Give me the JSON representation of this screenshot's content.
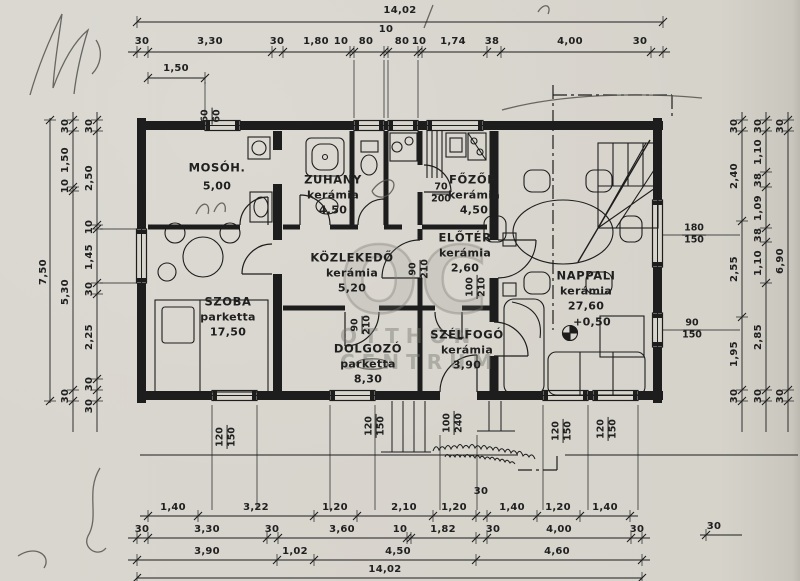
{
  "document": {
    "kind": "scanned floor plan",
    "language": "hu"
  },
  "watermark": {
    "monogram": "OC",
    "line1": "OTTHON",
    "line2": "CENTRUM"
  },
  "level_mark": {
    "text": "+0,50",
    "x": 592,
    "y": 322
  },
  "rooms": [
    {
      "name": "MOSÓH.",
      "finish": null,
      "area": "5,00",
      "x": 217,
      "y": 168
    },
    {
      "name": "ZUHANY",
      "finish": "kerámia",
      "area": "4,50",
      "x": 333,
      "y": 180
    },
    {
      "name": "FŐZŐF.",
      "finish": "kerámia",
      "area": "4,50",
      "x": 474,
      "y": 180
    },
    {
      "name": "ELŐTÉR",
      "finish": "kerámia",
      "area": "2,60",
      "x": 465,
      "y": 238
    },
    {
      "name": "KÖZLEKEDŐ",
      "finish": "kerámia",
      "area": "5,20",
      "x": 352,
      "y": 258
    },
    {
      "name": "SZOBA",
      "finish": "parketta",
      "area": "17,50",
      "x": 228,
      "y": 302
    },
    {
      "name": "DOLGOZÓ",
      "finish": "parketta",
      "area": "8,30",
      "x": 368,
      "y": 349
    },
    {
      "name": "SZÉLFOGÓ",
      "finish": "kerámia",
      "area": "3,90",
      "x": 467,
      "y": 335
    },
    {
      "name": "NAPPALI",
      "finish": "kerámia",
      "area": "27,60",
      "x": 586,
      "y": 276
    }
  ],
  "dim_labels": [
    {
      "t": "14,02",
      "x": 400,
      "y": 11
    },
    {
      "t": "30",
      "x": 142,
      "y": 42
    },
    {
      "t": "3,30",
      "x": 210,
      "y": 42
    },
    {
      "t": "30",
      "x": 277,
      "y": 42
    },
    {
      "t": "1,80",
      "x": 316,
      "y": 42
    },
    {
      "t": "10",
      "x": 341,
      "y": 42
    },
    {
      "t": "80",
      "x": 366,
      "y": 42
    },
    {
      "t": "10",
      "x": 386,
      "y": 30
    },
    {
      "t": "80",
      "x": 402,
      "y": 42
    },
    {
      "t": "10",
      "x": 419,
      "y": 42
    },
    {
      "t": "1,74",
      "x": 453,
      "y": 42
    },
    {
      "t": "38",
      "x": 492,
      "y": 42
    },
    {
      "t": "4,00",
      "x": 570,
      "y": 42
    },
    {
      "t": "30",
      "x": 640,
      "y": 42
    },
    {
      "t": "1,50",
      "x": 176,
      "y": 69
    },
    {
      "t": "1,40",
      "x": 173,
      "y": 508
    },
    {
      "t": "3,22",
      "x": 256,
      "y": 508
    },
    {
      "t": "1,20",
      "x": 335,
      "y": 508
    },
    {
      "t": "2,10",
      "x": 404,
      "y": 508
    },
    {
      "t": "1,20",
      "x": 454,
      "y": 508
    },
    {
      "t": "30",
      "x": 481,
      "y": 492
    },
    {
      "t": "1,40",
      "x": 512,
      "y": 508
    },
    {
      "t": "1,20",
      "x": 558,
      "y": 508
    },
    {
      "t": "1,40",
      "x": 605,
      "y": 508
    },
    {
      "t": "30",
      "x": 142,
      "y": 530
    },
    {
      "t": "3,30",
      "x": 207,
      "y": 530
    },
    {
      "t": "30",
      "x": 272,
      "y": 530
    },
    {
      "t": "3,60",
      "x": 342,
      "y": 530
    },
    {
      "t": "10",
      "x": 400,
      "y": 530
    },
    {
      "t": "1,82",
      "x": 443,
      "y": 530
    },
    {
      "t": "30",
      "x": 493,
      "y": 530
    },
    {
      "t": "4,00",
      "x": 559,
      "y": 530
    },
    {
      "t": "30",
      "x": 637,
      "y": 530
    },
    {
      "t": "3,90",
      "x": 207,
      "y": 552
    },
    {
      "t": "1,02",
      "x": 295,
      "y": 552
    },
    {
      "t": "4,50",
      "x": 398,
      "y": 552
    },
    {
      "t": "4,60",
      "x": 557,
      "y": 552
    },
    {
      "t": "14,02",
      "x": 385,
      "y": 570
    },
    {
      "t": "30",
      "x": 714,
      "y": 527
    },
    {
      "t": "7,50",
      "x": 44,
      "y": 272,
      "r": 1
    },
    {
      "t": "30",
      "x": 66,
      "y": 126,
      "r": 1
    },
    {
      "t": "1,50",
      "x": 66,
      "y": 160,
      "r": 1
    },
    {
      "t": "10",
      "x": 66,
      "y": 186,
      "r": 1
    },
    {
      "t": "5,30",
      "x": 66,
      "y": 292,
      "r": 1
    },
    {
      "t": "30",
      "x": 66,
      "y": 396,
      "r": 1
    },
    {
      "t": "30",
      "x": 90,
      "y": 126,
      "r": 1
    },
    {
      "t": "2,50",
      "x": 90,
      "y": 178,
      "r": 1
    },
    {
      "t": "10",
      "x": 90,
      "y": 227,
      "r": 1
    },
    {
      "t": "1,45",
      "x": 90,
      "y": 257,
      "r": 1
    },
    {
      "t": "30",
      "x": 90,
      "y": 289,
      "r": 1
    },
    {
      "t": "2,25",
      "x": 90,
      "y": 337,
      "r": 1
    },
    {
      "t": "30",
      "x": 90,
      "y": 384,
      "r": 1
    },
    {
      "t": "30",
      "x": 90,
      "y": 406,
      "r": 1
    },
    {
      "t": "30",
      "x": 735,
      "y": 126,
      "r": 1
    },
    {
      "t": "2,40",
      "x": 735,
      "y": 176,
      "r": 1
    },
    {
      "t": "2,55",
      "x": 735,
      "y": 269,
      "r": 1
    },
    {
      "t": "1,95",
      "x": 735,
      "y": 354,
      "r": 1
    },
    {
      "t": "30",
      "x": 735,
      "y": 396,
      "r": 1
    },
    {
      "t": "30",
      "x": 759,
      "y": 126,
      "r": 1
    },
    {
      "t": "1,10",
      "x": 759,
      "y": 152,
      "r": 1
    },
    {
      "t": "38",
      "x": 759,
      "y": 180,
      "r": 1
    },
    {
      "t": "1,09",
      "x": 759,
      "y": 208,
      "r": 1
    },
    {
      "t": "38",
      "x": 759,
      "y": 235,
      "r": 1
    },
    {
      "t": "1,10",
      "x": 759,
      "y": 263,
      "r": 1
    },
    {
      "t": "2,85",
      "x": 759,
      "y": 337,
      "r": 1
    },
    {
      "t": "30",
      "x": 759,
      "y": 396,
      "r": 1
    },
    {
      "t": "30",
      "x": 781,
      "y": 126,
      "r": 1
    },
    {
      "t": "6,90",
      "x": 781,
      "y": 261,
      "r": 1
    },
    {
      "t": "30",
      "x": 781,
      "y": 396,
      "r": 1
    }
  ],
  "fixture_pairs": [
    {
      "a": "60",
      "b": "60",
      "x": 212,
      "y": 116,
      "rot": 1
    },
    {
      "a": "70",
      "b": "200",
      "x": 441,
      "y": 194,
      "rot": 0
    },
    {
      "a": "90",
      "b": "210",
      "x": 420,
      "y": 269,
      "rot": 1
    },
    {
      "a": "90",
      "b": "210",
      "x": 362,
      "y": 325,
      "rot": 1
    },
    {
      "a": "100",
      "b": "210",
      "x": 477,
      "y": 287,
      "rot": 1
    },
    {
      "a": "100",
      "b": "240",
      "x": 454,
      "y": 423,
      "rot": 1
    },
    {
      "a": "120",
      "b": "150",
      "x": 227,
      "y": 437,
      "rot": 1
    },
    {
      "a": "120",
      "b": "150",
      "x": 376,
      "y": 426,
      "rot": 1
    },
    {
      "a": "120",
      "b": "150",
      "x": 563,
      "y": 431,
      "rot": 1
    },
    {
      "a": "120",
      "b": "150",
      "x": 608,
      "y": 429,
      "rot": 1
    },
    {
      "a": "180",
      "b": "150",
      "x": 694,
      "y": 235,
      "rot": 0
    },
    {
      "a": "90",
      "b": "150",
      "x": 692,
      "y": 330,
      "rot": 0
    }
  ],
  "dim_chains": [
    {
      "d": "h",
      "p": 22,
      "f": 137,
      "t": 663,
      "ticks": [
        137,
        663
      ]
    },
    {
      "d": "h",
      "p": 52,
      "f": 128,
      "t": 670,
      "ticks": [
        137,
        148,
        272,
        283,
        350,
        354,
        384,
        388,
        418,
        422,
        487,
        501,
        651,
        663
      ]
    },
    {
      "d": "h",
      "p": 78,
      "f": 148,
      "t": 205,
      "ticks": [
        148,
        205
      ]
    },
    {
      "d": "h",
      "p": 516,
      "f": 140,
      "t": 638,
      "ticks": [
        148,
        198,
        314,
        357,
        433,
        476,
        487,
        537,
        580,
        630
      ]
    },
    {
      "d": "h",
      "p": 538,
      "f": 128,
      "t": 650,
      "ticks": [
        137,
        148,
        267,
        278,
        407,
        411,
        476,
        487,
        631,
        642
      ]
    },
    {
      "d": "h",
      "p": 560,
      "f": 128,
      "t": 650,
      "ticks": [
        137,
        277,
        314,
        476,
        642
      ]
    },
    {
      "d": "h",
      "p": 578,
      "f": 137,
      "t": 642,
      "ticks": [
        137,
        642
      ]
    },
    {
      "d": "h",
      "p": 535,
      "f": 700,
      "t": 742,
      "ticks": [
        706
      ]
    },
    {
      "d": "v",
      "p": 50,
      "f": 118,
      "t": 403,
      "ticks": [
        120,
        401
      ]
    },
    {
      "d": "v",
      "p": 73,
      "f": 112,
      "t": 432,
      "ticks": [
        120,
        131,
        187,
        191,
        390,
        401
      ]
    },
    {
      "d": "v",
      "p": 97,
      "f": 112,
      "t": 432,
      "ticks": [
        120,
        131,
        225,
        229,
        283,
        294,
        379,
        390,
        401
      ]
    },
    {
      "d": "v",
      "p": 742,
      "f": 112,
      "t": 432,
      "ticks": [
        120,
        131,
        221,
        317,
        390,
        401
      ]
    },
    {
      "d": "v",
      "p": 766,
      "f": 112,
      "t": 432,
      "ticks": [
        120,
        131,
        172,
        187,
        228,
        242,
        283,
        390,
        401
      ]
    },
    {
      "d": "v",
      "p": 788,
      "f": 112,
      "t": 432,
      "ticks": [
        120,
        131,
        390,
        401
      ]
    }
  ],
  "leader_lines": [
    [
      354,
      60,
      354,
      118
    ],
    [
      384,
      60,
      384,
      118
    ],
    [
      388,
      60,
      388,
      118
    ],
    [
      418,
      60,
      418,
      118
    ],
    [
      205,
      82,
      205,
      118
    ],
    [
      212,
      405,
      212,
      510
    ],
    [
      257,
      405,
      257,
      510
    ],
    [
      330,
      405,
      330,
      510
    ],
    [
      375,
      405,
      375,
      510
    ],
    [
      543,
      405,
      543,
      510
    ],
    [
      588,
      405,
      588,
      510
    ],
    [
      638,
      405,
      638,
      510
    ],
    [
      440,
      435,
      440,
      510
    ],
    [
      477,
      435,
      477,
      510
    ],
    [
      100,
      229,
      137,
      229
    ],
    [
      100,
      283,
      137,
      283
    ],
    [
      663,
      235,
      740,
      235
    ],
    [
      663,
      330,
      740,
      330
    ]
  ]
}
